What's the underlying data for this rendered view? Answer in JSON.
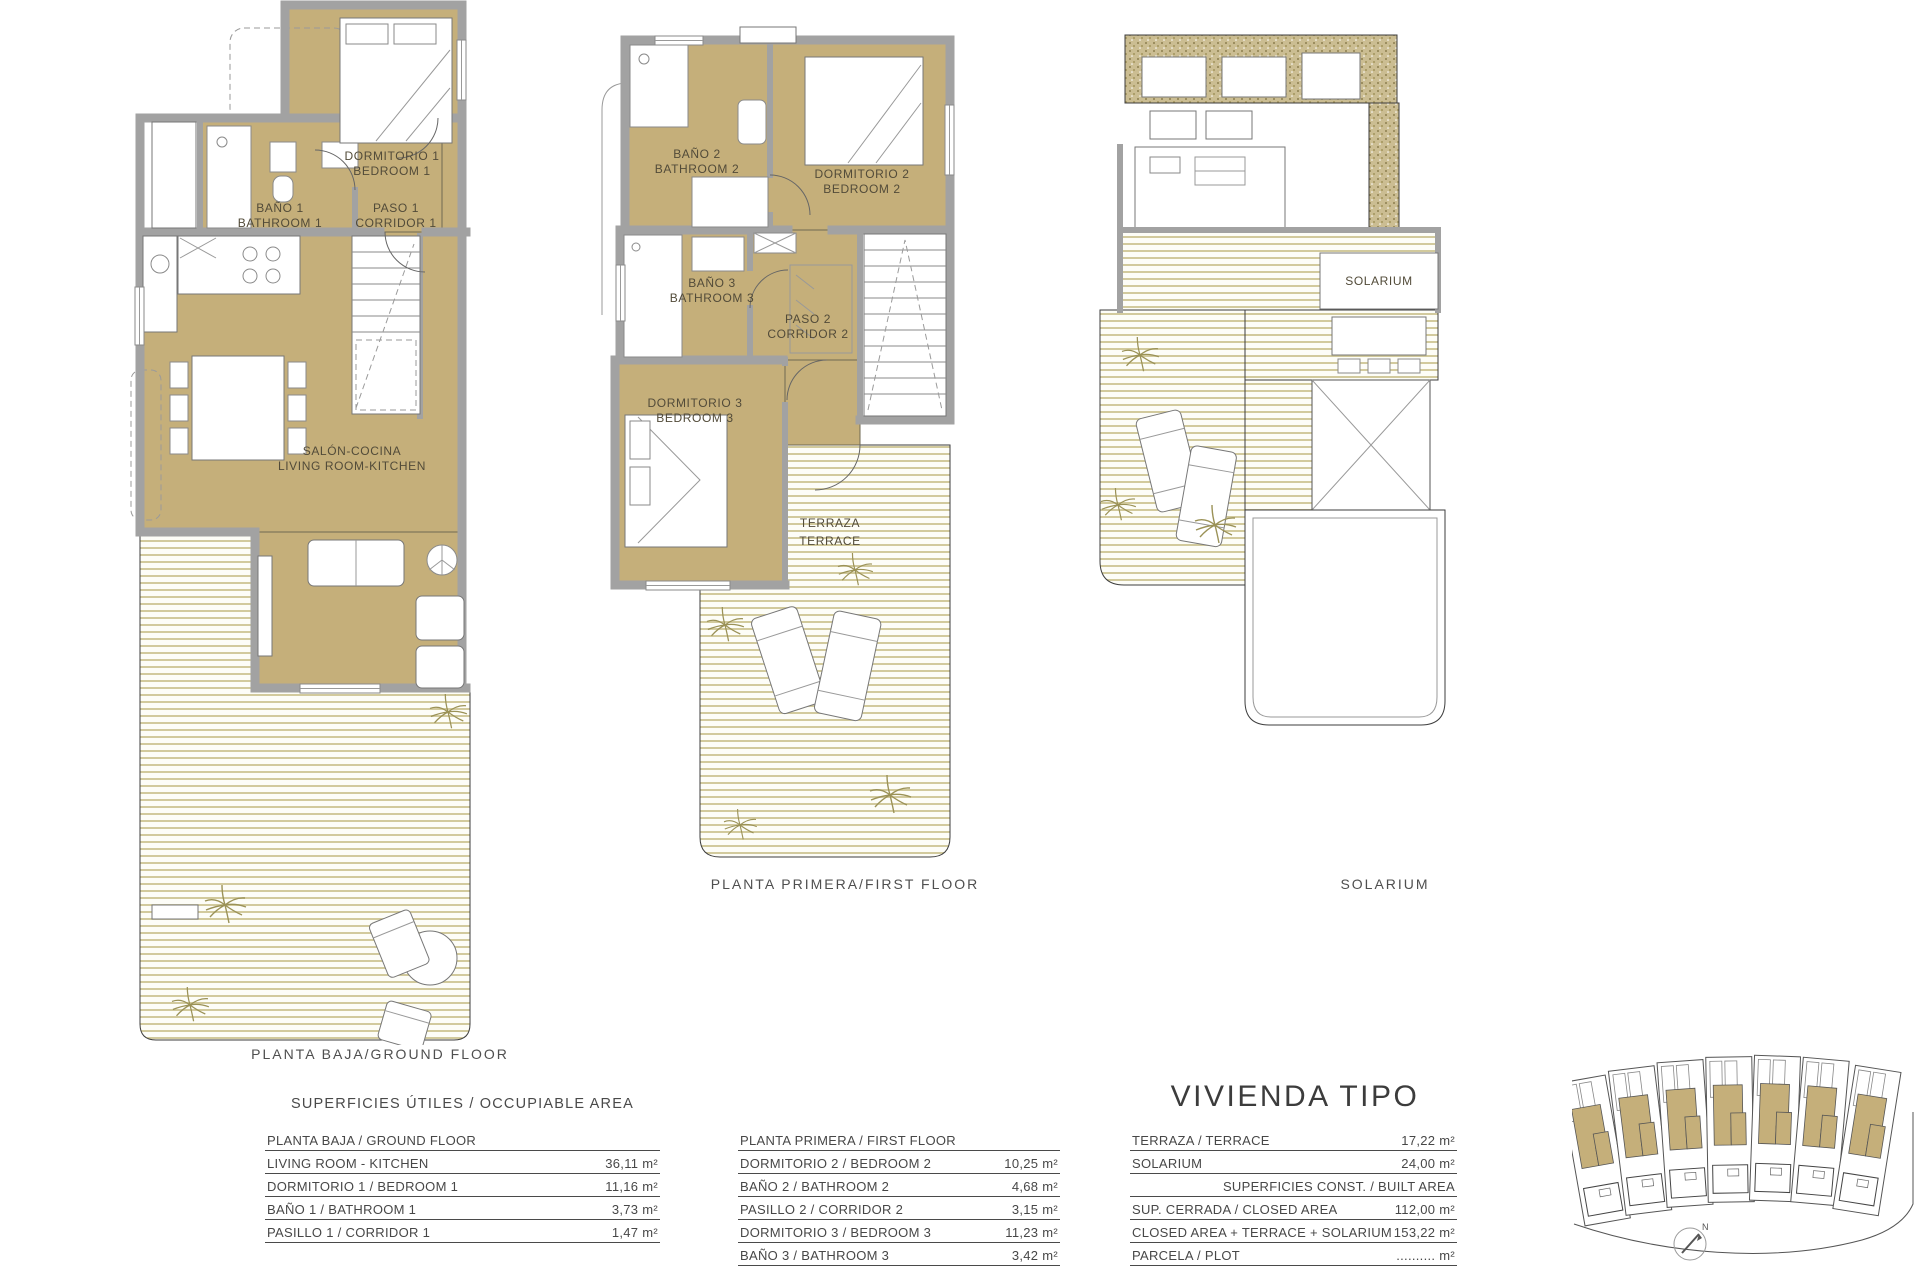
{
  "plans": {
    "ground": {
      "caption": "PLANTA BAJA/GROUND FLOOR",
      "rooms": {
        "bano1": [
          "BAÑO 1",
          "BATHROOM 1"
        ],
        "paso1": [
          "PASO 1",
          "CORRIDOR 1"
        ],
        "dorm1": [
          "DORMITORIO 1",
          "BEDROOM 1"
        ],
        "salon": [
          "SALÓN-COCINA",
          "LIVING ROOM-KITCHEN"
        ]
      }
    },
    "first": {
      "caption": "PLANTA PRIMERA/FIRST FLOOR",
      "rooms": {
        "bano2": [
          "BAÑO 2",
          "BATHROOM 2"
        ],
        "dorm2": [
          "DORMITORIO 2",
          "BEDROOM 2"
        ],
        "bano3": [
          "BAÑO 3",
          "BATHROOM 3"
        ],
        "paso2": [
          "PASO 2",
          "CORRIDOR 2"
        ],
        "dorm3": [
          "DORMITORIO 3",
          "BEDROOM 3"
        ],
        "terraza": [
          "TERRAZA",
          "TERRACE"
        ]
      }
    },
    "solarium": {
      "caption": "SOLARIUM",
      "room_label": "SOLARIUM"
    }
  },
  "tables": {
    "title": "SUPERFICIES ÚTILES / OCCUPIABLE AREA",
    "ground": {
      "header": "PLANTA BAJA / GROUND FLOOR",
      "rows": [
        {
          "label": "LIVING ROOM - KITCHEN",
          "value": "36,11 m²"
        },
        {
          "label": "DORMITORIO 1 /  BEDROOM 1",
          "value": "11,16 m²"
        },
        {
          "label": "BAÑO 1 / BATHROOM 1",
          "value": "3,73 m²"
        },
        {
          "label": "PASILLO 1 / CORRIDOR 1",
          "value": "1,47 m²"
        }
      ]
    },
    "first": {
      "header": "PLANTA PRIMERA / FIRST FLOOR",
      "rows": [
        {
          "label": "DORMITORIO 2 / BEDROOM 2",
          "value": "10,25 m²"
        },
        {
          "label": "BAÑO 2 / BATHROOM 2",
          "value": "4,68 m²"
        },
        {
          "label": "PASILLO 2 / CORRIDOR 2",
          "value": "3,15 m²"
        },
        {
          "label": "DORMITORIO 3 / BEDROOM 3",
          "value": "11,23 m²"
        },
        {
          "label": "BAÑO 3 / BATHROOM 3",
          "value": "3,42 m²"
        }
      ]
    },
    "summary": {
      "title": "VIVIENDA TIPO",
      "rows": [
        {
          "label": "TERRAZA / TERRACE",
          "value": "17,22 m²"
        },
        {
          "label": "SOLARIUM",
          "value": "24,00 m²"
        },
        {
          "label": "SUPERFICIES  CONST. / BUILT AREA",
          "value": ""
        },
        {
          "label": "SUP. CERRADA / CLOSED AREA",
          "value": "112,00 m²"
        },
        {
          "label": "CLOSED AREA + TERRACE + SOLARIUM",
          "value": "153,22 m²"
        },
        {
          "label": "PARCELA / PLOT",
          "value": ".......... m²"
        }
      ]
    }
  },
  "siteplan": {
    "north": "N"
  },
  "colors": {
    "room_fill": "#c5af7a",
    "wall_gray": "#a2a2a2",
    "terrace_stripe": "#cdc493",
    "speckle": "#8d7f4e",
    "text": "#4a4a4a"
  }
}
